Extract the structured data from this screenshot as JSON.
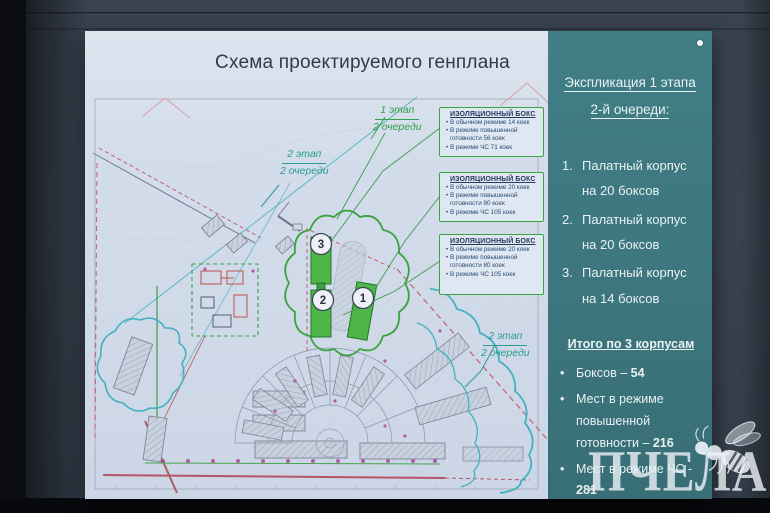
{
  "board": {
    "title": "Схема проектируемого генплана"
  },
  "plan": {
    "stage_labels": [
      {
        "line1": "1 этап",
        "line2": "2 очереди"
      },
      {
        "line1": "2 этап",
        "line2": "2 очереди"
      },
      {
        "line1": "2 этап",
        "line2": "2 очереди"
      }
    ],
    "isolation_boxes": [
      {
        "title": "ИЗОЛЯЦИОННЫЙ БОКС",
        "items": [
          "В обычном режиме 14 коек",
          "В режиме повышенной готовности 56 коек",
          "В режиме ЧС 71 коек"
        ]
      },
      {
        "title": "ИЗОЛЯЦИОННЫЙ БОКС",
        "items": [
          "В обычном режиме 20 коек",
          "В режиме повышенной готовности 80 коек",
          "В режиме ЧС 105 коек"
        ]
      },
      {
        "title": "ИЗОЛЯЦИОННЫЙ БОКС",
        "items": [
          "В обычном режиме 20 коек",
          "В режиме повышенной готовности 80 коек",
          "В режиме ЧС 105 коек"
        ]
      }
    ],
    "building_numbers": [
      "1",
      "2",
      "3"
    ]
  },
  "sidebar": {
    "heading_line1": "Экспликация 1 этапа",
    "heading_line2": "2-й очереди:",
    "items": [
      {
        "num": "1.",
        "text": "Палатный корпус на 20 боксов"
      },
      {
        "num": "2.",
        "text": "Палатный корпус на 20 боксов"
      },
      {
        "num": "3.",
        "text": "Палатный корпус на 14 боксов"
      }
    ],
    "totals_heading": "Итого по 3 корпусам",
    "totals": [
      {
        "label": "Боксов – ",
        "value": "54"
      },
      {
        "label": "Мест в режиме повышенной готовности – ",
        "value": "216"
      },
      {
        "label": "Мест в режиме ЧС - ",
        "value": "281"
      }
    ]
  },
  "watermark": {
    "text": "ПЧЕЛА"
  },
  "ui": {
    "bullet": "•"
  },
  "colors": {
    "sidebar_teal": "#3F7B83",
    "annotation_green": "#3AA53F",
    "building_green": "#4EB548",
    "cloud_teal": "#45B1C2",
    "boundary_red": "#C2606E",
    "paper": "#D2DCEA",
    "wall": "#3A4451"
  }
}
